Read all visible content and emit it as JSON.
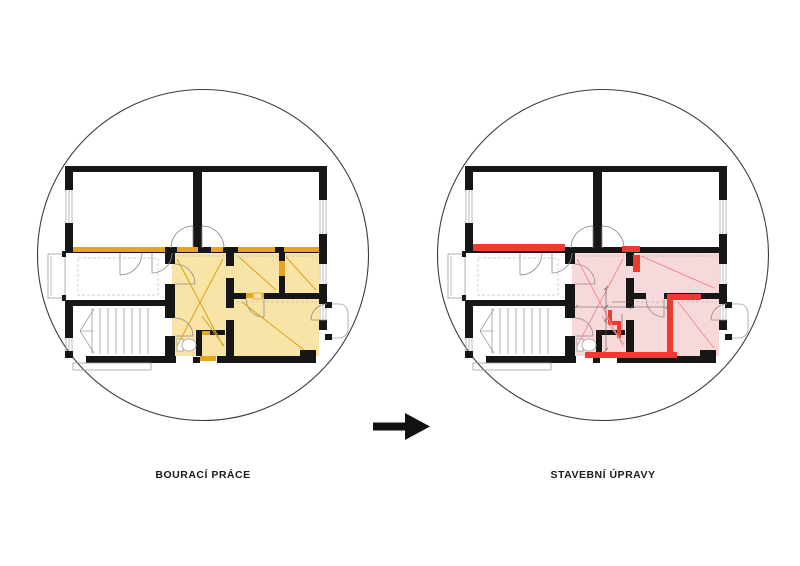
{
  "scene": {
    "background": "#ffffff"
  },
  "panels": [
    {
      "id": "demolition",
      "label": "BOURACÍ PRÁCE",
      "highlight_color": "#F7E4A6",
      "accent_color": "#E7A51D",
      "diagonal_color": "#D9A31C"
    },
    {
      "id": "construction",
      "label": "STAVEBNÍ ÚPRAVY",
      "highlight_color": "#F8D9DB",
      "accent_color": "#EE3B30",
      "diagonal_color": "#F0908C"
    }
  ],
  "arrow": {
    "icon": "right-arrow-icon",
    "color": "#111111"
  },
  "plan_style": {
    "wall_color": "#161616",
    "thin_line_color": "#9aa0a6",
    "door_arc_color": "#8c8c8c",
    "dashed_line_color": "#bdbdbd",
    "dimension_color": "#555555",
    "circle_outline_color": "#3c3c3c"
  }
}
